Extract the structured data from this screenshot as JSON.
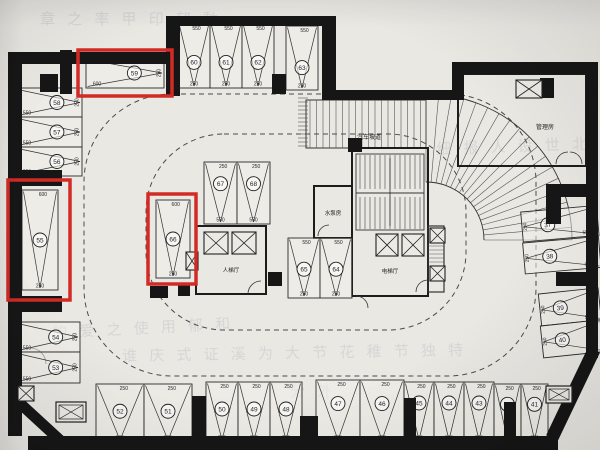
{
  "drawing": {
    "type": "basement-parking-floor-plan",
    "paper_color": "#eae8e3",
    "wall_color": "#161616",
    "line_color": "#2e2e2e",
    "highlight_color": "#d22a25"
  },
  "room_labels": [
    {
      "id": "car-ramp",
      "text": "汽车坡道",
      "x": 369,
      "y": 139,
      "fs": 6
    },
    {
      "id": "management-room",
      "text": "管理房",
      "x": 545,
      "y": 129,
      "fs": 6
    },
    {
      "id": "pump-room",
      "text": "水泵房",
      "x": 333,
      "y": 215,
      "fs": 5.5
    },
    {
      "id": "passenger-lift-lobby",
      "text": "人梯厅",
      "x": 231,
      "y": 272,
      "fs": 5.5
    },
    {
      "id": "lift-lobby",
      "text": "电梯厅",
      "x": 390,
      "y": 273,
      "fs": 5.5
    }
  ],
  "watermarks": [
    {
      "text": "章 之 率 甲 印 郁 動",
      "x": 40,
      "y": 12,
      "rot": 0
    },
    {
      "text": "细 报 人 设 世 北",
      "x": 436,
      "y": 142,
      "rot": -2
    },
    {
      "text": "的 爱 之 使 用 郁 和",
      "x": 52,
      "y": 326,
      "rot": -3
    },
    {
      "text": "谁 庆 式 证 溪 为 大 节 花 稚 节 独 特",
      "x": 122,
      "y": 349,
      "rot": -1
    },
    {
      "text": "分 外",
      "x": 290,
      "y": 384,
      "rot": 0
    }
  ],
  "highlighted_stalls": [
    "59",
    "55",
    "66"
  ],
  "highlight_boxes": [
    {
      "x": 78,
      "y": 50,
      "w": 94,
      "h": 46
    },
    {
      "x": 8,
      "y": 180,
      "w": 62,
      "h": 120
    },
    {
      "x": 148,
      "y": 194,
      "w": 48,
      "h": 90
    }
  ],
  "stalls": [
    {
      "n": "59",
      "x": 86,
      "y": 58,
      "w": 78,
      "h": 30,
      "o": "hr",
      "d": [
        "600",
        "250"
      ],
      "red": true
    },
    {
      "n": "60",
      "x": 178,
      "y": 24,
      "w": 32,
      "h": 64,
      "o": "v",
      "d": [
        "550",
        "250"
      ],
      "cy": 0.6
    },
    {
      "n": "61",
      "x": 210,
      "y": 24,
      "w": 32,
      "h": 64,
      "o": "v",
      "d": [
        "550",
        "250"
      ],
      "cy": 0.6
    },
    {
      "n": "62",
      "x": 242,
      "y": 24,
      "w": 32,
      "h": 64,
      "o": "v",
      "d": [
        "550",
        "250"
      ],
      "cy": 0.6
    },
    {
      "n": "63",
      "x": 286,
      "y": 26,
      "w": 32,
      "h": 64,
      "o": "v",
      "d": [
        "550",
        "250"
      ],
      "cy": 0.65
    },
    {
      "n": "58",
      "x": 16,
      "y": 88,
      "w": 66,
      "h": 29,
      "o": "hr",
      "d": [
        "550",
        "250"
      ]
    },
    {
      "n": "57",
      "x": 16,
      "y": 117,
      "w": 66,
      "h": 30,
      "o": "hr",
      "d": [
        "550",
        "250"
      ]
    },
    {
      "n": "56",
      "x": 16,
      "y": 147,
      "w": 66,
      "h": 29,
      "o": "hr",
      "d": [
        "550",
        "250"
      ]
    },
    {
      "n": "55",
      "x": 22,
      "y": 190,
      "w": 36,
      "h": 100,
      "o": "v",
      "d": [
        "600",
        "250"
      ],
      "red": true
    },
    {
      "n": "54",
      "x": 16,
      "y": 322,
      "w": 64,
      "h": 30,
      "o": "hr",
      "d": [
        "550",
        "250"
      ]
    },
    {
      "n": "53",
      "x": 16,
      "y": 352,
      "w": 64,
      "h": 31,
      "o": "hr",
      "d": [
        "550",
        "250"
      ]
    },
    {
      "n": "66",
      "x": 156,
      "y": 200,
      "w": 34,
      "h": 78,
      "o": "v",
      "d": [
        "600",
        "250"
      ],
      "red": true
    },
    {
      "n": "67",
      "x": 204,
      "y": 162,
      "w": 33,
      "h": 62,
      "o": "v",
      "d": [
        "250",
        "550"
      ],
      "cy": 0.35
    },
    {
      "n": "68",
      "x": 237,
      "y": 162,
      "w": 33,
      "h": 62,
      "o": "v",
      "d": [
        "250",
        "550"
      ],
      "cy": 0.35
    },
    {
      "n": "65",
      "x": 288,
      "y": 238,
      "w": 32,
      "h": 60,
      "o": "v",
      "d": [
        "550",
        "250"
      ],
      "cy": 0.52
    },
    {
      "n": "64",
      "x": 320,
      "y": 238,
      "w": 32,
      "h": 60,
      "o": "v",
      "d": [
        "550",
        "250"
      ],
      "cy": 0.52
    },
    {
      "n": "37",
      "x": 522,
      "y": 212,
      "w": 76,
      "h": 30,
      "o": "hl",
      "d": [
        "250",
        "550"
      ],
      "rot": -5
    },
    {
      "n": "38",
      "x": 524,
      "y": 243,
      "w": 76,
      "h": 31,
      "o": "hl",
      "d": [
        "250",
        "550"
      ],
      "rot": -5
    },
    {
      "n": "39",
      "x": 540,
      "y": 294,
      "w": 60,
      "h": 32,
      "o": "hl",
      "d": [
        "250",
        "550"
      ],
      "rot": -6
    },
    {
      "n": "40",
      "x": 542,
      "y": 326,
      "w": 60,
      "h": 32,
      "o": "hl",
      "d": [
        "250",
        "550"
      ],
      "rot": -6
    },
    {
      "n": "52",
      "x": 96,
      "y": 384,
      "w": 48,
      "h": 58,
      "o": "v",
      "d": [
        "250",
        "550"
      ],
      "cy": 0.47
    },
    {
      "n": "51",
      "x": 144,
      "y": 384,
      "w": 48,
      "h": 58,
      "o": "v",
      "d": [
        "250",
        "550"
      ],
      "cy": 0.47
    },
    {
      "n": "50",
      "x": 206,
      "y": 382,
      "w": 32,
      "h": 60,
      "o": "v",
      "d": [
        "250",
        "550"
      ],
      "cy": 0.45
    },
    {
      "n": "49",
      "x": 238,
      "y": 382,
      "w": 32,
      "h": 60,
      "o": "v",
      "d": [
        "250",
        "550"
      ],
      "cy": 0.45
    },
    {
      "n": "48",
      "x": 270,
      "y": 382,
      "w": 32,
      "h": 60,
      "o": "v",
      "d": [
        "250",
        "550"
      ],
      "cy": 0.45
    },
    {
      "n": "47",
      "x": 316,
      "y": 380,
      "w": 44,
      "h": 62,
      "o": "v",
      "d": [
        "250",
        "550"
      ],
      "cy": 0.38
    },
    {
      "n": "46",
      "x": 360,
      "y": 380,
      "w": 44,
      "h": 62,
      "o": "v",
      "d": [
        "250",
        "550"
      ],
      "cy": 0.38
    },
    {
      "n": "45",
      "x": 404,
      "y": 382,
      "w": 30,
      "h": 60,
      "o": "v",
      "d": [
        "250",
        "550"
      ],
      "cy": 0.35
    },
    {
      "n": "44",
      "x": 434,
      "y": 382,
      "w": 30,
      "h": 60,
      "o": "v",
      "d": [
        "250",
        "550"
      ],
      "cy": 0.35
    },
    {
      "n": "43",
      "x": 464,
      "y": 382,
      "w": 30,
      "h": 60,
      "o": "v",
      "d": [
        "250",
        "550"
      ],
      "cy": 0.35
    },
    {
      "n": "42",
      "x": 494,
      "y": 384,
      "w": 27,
      "h": 58,
      "o": "v",
      "d": [
        "250",
        "550"
      ],
      "cy": 0.35
    },
    {
      "n": "41",
      "x": 521,
      "y": 384,
      "w": 27,
      "h": 58,
      "o": "v",
      "d": [
        "250",
        "550"
      ],
      "cy": 0.35
    }
  ]
}
